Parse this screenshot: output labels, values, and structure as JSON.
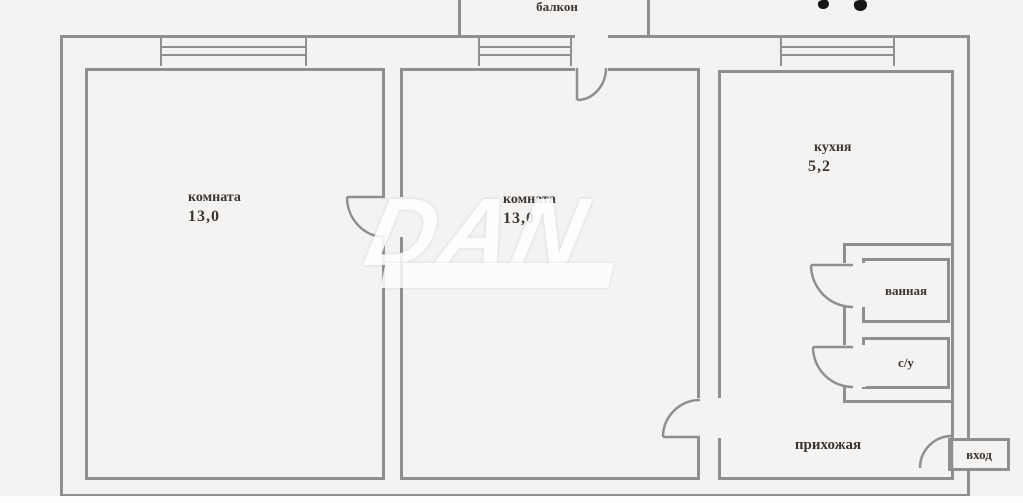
{
  "plan": {
    "balcony_label": "балкон",
    "room_left": {
      "name": "комната",
      "area": "13,0"
    },
    "room_mid": {
      "name": "комната",
      "area": "13,0"
    },
    "kitchen": {
      "name": "кухня",
      "area": "5,2"
    },
    "bathroom_label": "ванная",
    "wc_label": "с/у",
    "hallway_label": "прихожая",
    "entrance_label": "вход",
    "watermark": "DAN"
  },
  "colors": {
    "wall": "#8f8f8f",
    "text": "#3a3633",
    "bg": "#f4f3f1",
    "watermark": "#ffffff"
  }
}
